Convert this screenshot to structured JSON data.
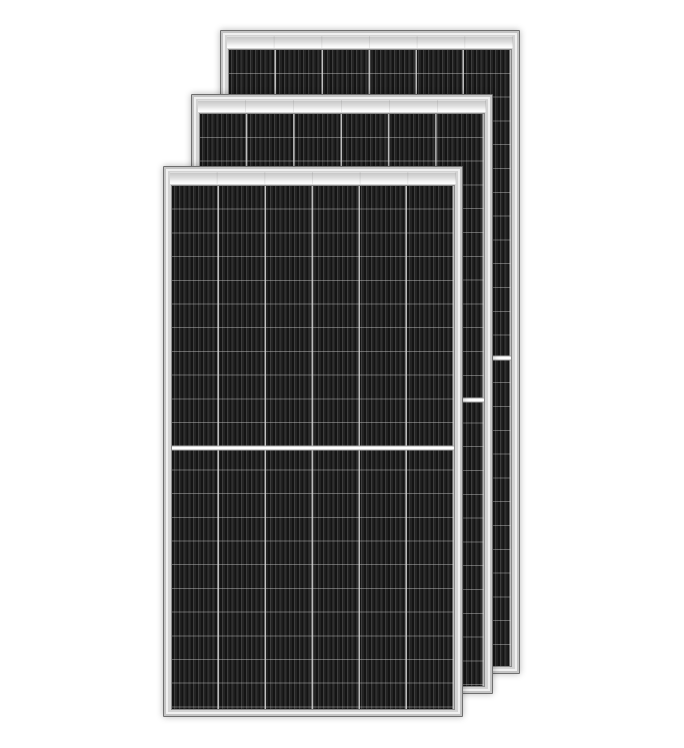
{
  "scene": {
    "description": "Product photo of three framed monocrystalline half-cut solar panel modules overlapping diagonally on a white background, front panel lower-left, back panel upper-right",
    "background_color": "#ffffff",
    "text_content": "none"
  },
  "panels": [
    {
      "name": "solar-panel-back",
      "left": 220,
      "top": 30,
      "width": 300,
      "height": 644,
      "z": 1,
      "columns": 6,
      "row_pitch_px": 23.8,
      "center_divider_at_percent": 50
    },
    {
      "name": "solar-panel-middle",
      "left": 191,
      "top": 94,
      "width": 302,
      "height": 600,
      "z": 2,
      "columns": 6,
      "row_pitch_px": 23.8,
      "center_divider_at_percent": 50
    },
    {
      "name": "solar-panel-front",
      "left": 163,
      "top": 166,
      "width": 300,
      "height": 551,
      "z": 3,
      "columns": 6,
      "row_pitch_px": 23.7,
      "center_divider_at_percent": 50
    }
  ],
  "colors": {
    "frame_fill": "#d3d3d3",
    "frame_edge": "#6f6f6f",
    "frame_ring_outer": "#c4c4c4",
    "frame_ring_inner": "#f0f0f0",
    "bar_top": "#c8c8c8",
    "bar_bottom": "#ffffff",
    "cell_base": "#1f1f1f",
    "stripe_dark": "#141414",
    "stripe_mid": "#3d3d3d",
    "stripe_base": "#232323",
    "col_divider": "rgba(216,216,216,0.85)",
    "row_line": "rgba(206,206,206,0.42)",
    "gap_fill": "#ffffff",
    "gap_edge": "#a5a5a5"
  }
}
